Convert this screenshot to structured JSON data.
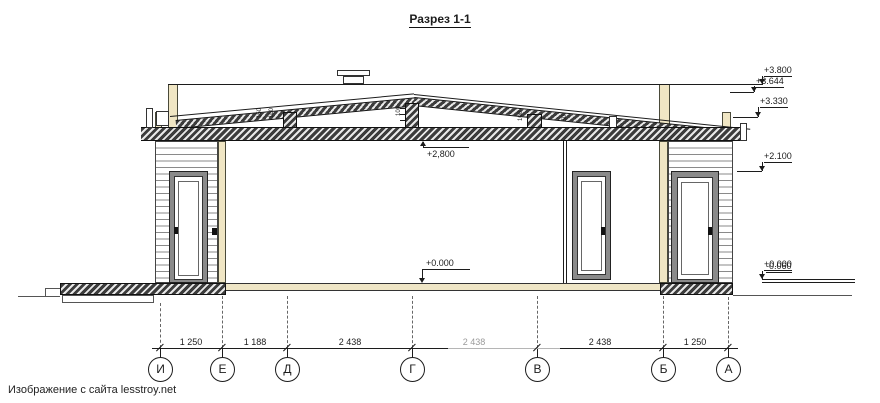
{
  "title": "Разрез 1-1",
  "footer": "Изображение с сайта lesstroy.net",
  "colors": {
    "beige": "#f0e6c4",
    "floor_tan": "#efe6c6",
    "line": "#1c1c1c",
    "dim_faded": "#9a9a9a"
  },
  "elevations": {
    "items": [
      "+3.800",
      "+3.644",
      "+3.330",
      "+2.100"
    ],
    "floor_plus": "+0.000",
    "floor_minus": "-0.060"
  },
  "marks": {
    "ceiling": "+2,800",
    "floor": "+0.000"
  },
  "truss": {
    "labels": [
      "150",
      "100",
      "100",
      "100",
      "50"
    ]
  },
  "dims": {
    "values": [
      "1 250",
      "1 188",
      "2 438",
      "2 438",
      "2 438",
      "1 250"
    ]
  },
  "axes": {
    "labels": [
      "И",
      "Е",
      "Д",
      "Г",
      "В",
      "Б",
      "А"
    ]
  }
}
